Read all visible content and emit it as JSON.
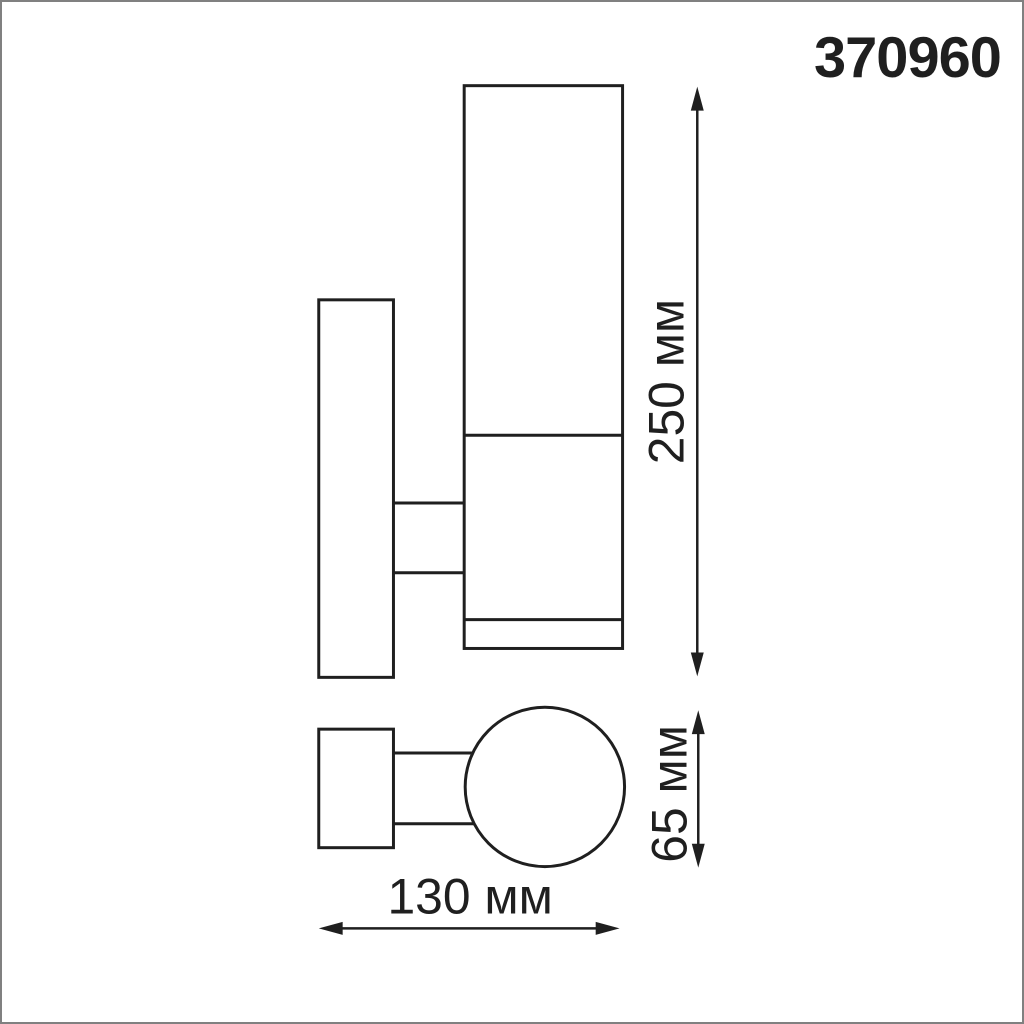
{
  "product_code": "370960",
  "dimensions": {
    "height_label": "250 мм",
    "diameter_label": "65 мм",
    "width_label": "130 мм"
  },
  "views": {
    "side_view": "wall lamp side elevation with mounting plate, arm and cylindrical body",
    "bottom_view": "wall lamp bottom view with mounting plate, arm and circular body"
  },
  "colors": {
    "line": "#1f1f1f",
    "background": "#ffffff",
    "border": "#808080"
  }
}
